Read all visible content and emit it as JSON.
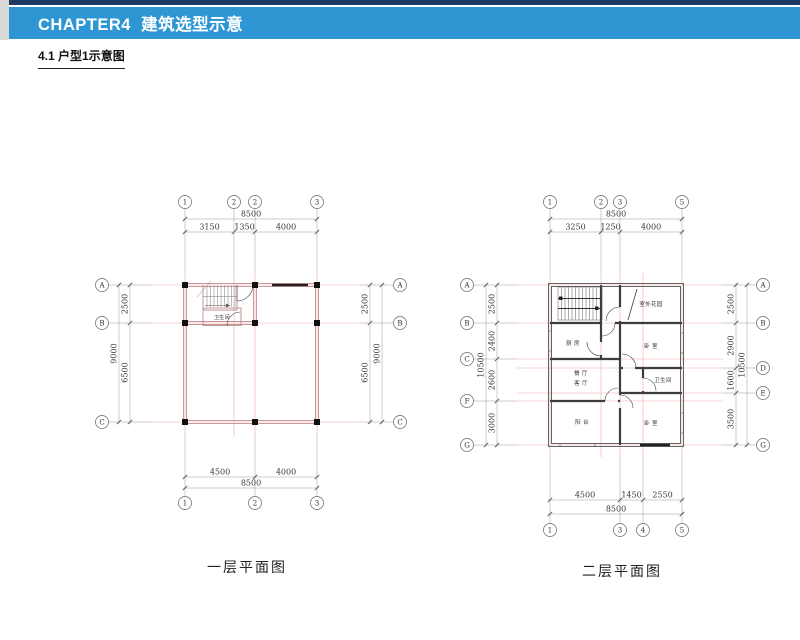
{
  "header": {
    "chapter": "CHAPTER4  建筑选型示意",
    "section": "4.1 户型1示意图"
  },
  "colors": {
    "header_bar": "#2e96d3",
    "top_strip": "#1f3b63",
    "left_strip": "#d9d9d9",
    "axis_grid_line": "#f0a8a8",
    "wall_plan1": "#b37070",
    "wall_plan2": "#3d3d3d",
    "column_fill": "#111111"
  },
  "plan1": {
    "caption": "一层平面图",
    "grid": {
      "top": [
        "1",
        "2",
        "2",
        "3"
      ],
      "bottom": [
        "1",
        "2",
        "3"
      ],
      "left": [
        "A",
        "B",
        "C"
      ],
      "right": [
        "A",
        "B",
        "C"
      ]
    },
    "dims": {
      "top_total": "8500",
      "top": [
        "3150",
        "1350",
        "4000"
      ],
      "bottom": [
        "4500",
        "4000"
      ],
      "bottom_total": "8500",
      "left": [
        "2500",
        "6500"
      ],
      "left_total": "9000",
      "right": [
        "2500",
        "6500"
      ],
      "right_total": "9000"
    },
    "rooms": {
      "bathroom": "卫生间"
    }
  },
  "plan2": {
    "caption": "二层平面图",
    "grid": {
      "top": [
        "1",
        "2",
        "3",
        "5"
      ],
      "bottom": [
        "1",
        "3",
        "4",
        "5"
      ],
      "left": [
        "A",
        "B",
        "C",
        "F",
        "G"
      ],
      "right": [
        "A",
        "B",
        "D",
        "E",
        "G"
      ]
    },
    "dims": {
      "top_total": "8500",
      "top": [
        "3250",
        "1250",
        "4000"
      ],
      "bottom": [
        "4500",
        "1450",
        "2550"
      ],
      "bottom_total": "8500",
      "left": [
        "2500",
        "2400",
        "2600",
        "3000"
      ],
      "left_total": "10500",
      "right": [
        "2500",
        "2900",
        "1600",
        "3500"
      ],
      "right_total": "10500"
    },
    "rooms": {
      "garden": "室外花园",
      "kitchen": "厨 房",
      "bedroom_top": "卧 室",
      "dining": "餐 厅",
      "living": "客 厅",
      "bathroom": "卫生间",
      "balcony": "阳 台",
      "bedroom_bottom": "卧 室"
    }
  }
}
